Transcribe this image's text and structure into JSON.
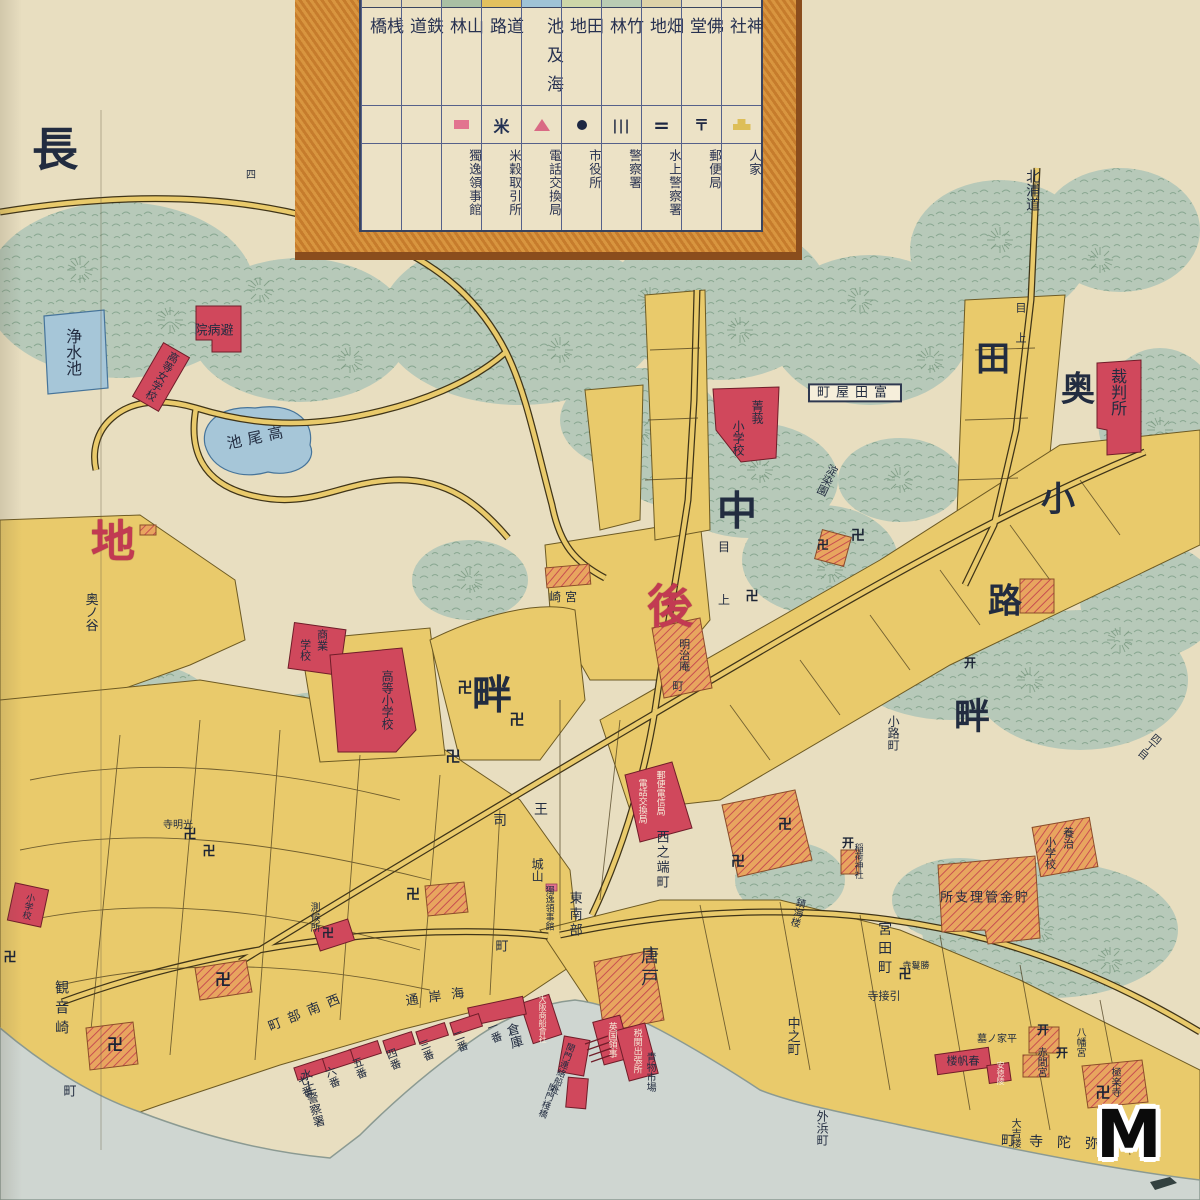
{
  "colors": {
    "paper": "#e8dec0",
    "sea": "#cfd6d1",
    "vegetation": "#b7c9b9",
    "block_yellow": "#e9ca6b",
    "building_red": "#d0485c",
    "temple_hatch": "#e8a55f",
    "pond_blue": "#a6c6d8",
    "legend_border_orange": "#d8953f",
    "ink_navy": "#273150",
    "accent_red_text": "#c23a52"
  },
  "watermark": {
    "text": "M"
  },
  "legend": {
    "columns": [
      {
        "terrain": "桟橋",
        "symbol": "none",
        "facility": "",
        "swatch": "#e4d9b8"
      },
      {
        "terrain": "鉄道",
        "symbol": "none",
        "facility": "",
        "swatch": "#e4d9b8"
      },
      {
        "terrain": "山林",
        "symbol": "pink-rect",
        "facility": "獨逸領事館",
        "swatch": "#a9bfa4"
      },
      {
        "terrain": "道路",
        "symbol": "rice-mark",
        "facility": "米穀取引所",
        "swatch": "#e2c05e"
      },
      {
        "terrain": "池及海",
        "symbol": "pink-triangle",
        "facility": "電話交換局",
        "swatch": "#9fc3d6"
      },
      {
        "terrain": "田地",
        "symbol": "black-circle",
        "facility": "市役所",
        "swatch": "#cdd6a8"
      },
      {
        "terrain": "竹林",
        "symbol": "triple-bar",
        "facility": "警察署",
        "swatch": "#b9ccb4"
      },
      {
        "terrain": "畑地",
        "symbol": "double-bar",
        "facility": "水上警察署",
        "swatch": "#ded2a8"
      },
      {
        "terrain": "佛堂",
        "symbol": "postal-mark",
        "facility": "郵便局",
        "swatch": "#e8dfc4"
      },
      {
        "terrain": "神社",
        "symbol": "house-shape",
        "facility": "人家",
        "swatch": "#e8dfc4"
      }
    ]
  },
  "map": {
    "labels": [
      {
        "t": "長",
        "x": 55,
        "y": 150,
        "o": "h",
        "s": 46,
        "c": "big"
      },
      {
        "t": "地",
        "x": 113,
        "y": 543,
        "o": "h",
        "s": 44,
        "c": "red big"
      },
      {
        "t": "後",
        "x": 670,
        "y": 607,
        "o": "h",
        "s": 46,
        "c": "red big"
      },
      {
        "t": "中",
        "x": 737,
        "y": 512,
        "o": "h",
        "s": 40,
        "c": "big"
      },
      {
        "t": "畔",
        "x": 492,
        "y": 696,
        "o": "h",
        "s": 40,
        "c": "big"
      },
      {
        "t": "畔",
        "x": 972,
        "y": 717,
        "o": "h",
        "s": 36,
        "c": "big"
      },
      {
        "t": "田",
        "x": 993,
        "y": 360,
        "o": "h",
        "s": 34,
        "c": "big"
      },
      {
        "t": "奥",
        "x": 1078,
        "y": 390,
        "o": "h",
        "s": 34,
        "c": "big"
      },
      {
        "t": "小",
        "x": 1058,
        "y": 500,
        "o": "h",
        "s": 34,
        "c": "big"
      },
      {
        "t": "路",
        "x": 1005,
        "y": 602,
        "o": "h",
        "s": 34,
        "c": "big"
      },
      {
        "t": "北浦道",
        "x": 1032,
        "y": 190,
        "o": "v",
        "s": 14
      },
      {
        "t": "浄水池",
        "x": 72,
        "y": 352,
        "o": "v",
        "s": 16
      },
      {
        "t": "池尾高",
        "x": 258,
        "y": 438,
        "o": "h",
        "s": 15,
        "r": -12,
        "ls": 6
      },
      {
        "t": "院病避",
        "x": 214,
        "y": 331,
        "o": "h",
        "s": 13
      },
      {
        "t": "高等女学校",
        "x": 162,
        "y": 376,
        "o": "v",
        "s": 11,
        "r": 30
      },
      {
        "t": "菁莪",
        "x": 757,
        "y": 412,
        "o": "v",
        "s": 12
      },
      {
        "t": "小学校",
        "x": 738,
        "y": 438,
        "o": "v",
        "s": 12
      },
      {
        "t": "町屋田富",
        "x": 855,
        "y": 393,
        "o": "h",
        "s": 13,
        "bg": "box",
        "ls": 6
      },
      {
        "t": "裁判所",
        "x": 1117,
        "y": 392,
        "o": "v",
        "s": 16
      },
      {
        "t": "淀染園",
        "x": 827,
        "y": 480,
        "o": "v",
        "s": 11,
        "r": 25
      },
      {
        "t": "崎宮",
        "x": 565,
        "y": 597,
        "o": "h",
        "s": 12,
        "ls": 4
      },
      {
        "t": "目",
        "x": 724,
        "y": 547,
        "o": "h",
        "s": 12
      },
      {
        "t": "上",
        "x": 724,
        "y": 600,
        "o": "h",
        "s": 12
      },
      {
        "t": "明治庵",
        "x": 684,
        "y": 655,
        "o": "v",
        "s": 11
      },
      {
        "t": "町",
        "x": 678,
        "y": 686,
        "o": "h",
        "s": 11
      },
      {
        "t": "奥ノ谷",
        "x": 90,
        "y": 612,
        "o": "v",
        "s": 13
      },
      {
        "t": "商業",
        "x": 322,
        "y": 640,
        "o": "v",
        "s": 11
      },
      {
        "t": "学校",
        "x": 305,
        "y": 650,
        "o": "v",
        "s": 11
      },
      {
        "t": "高等小学校",
        "x": 387,
        "y": 700,
        "o": "v",
        "s": 12
      },
      {
        "t": "王",
        "x": 541,
        "y": 810,
        "o": "h",
        "s": 14
      },
      {
        "t": "司",
        "x": 500,
        "y": 821,
        "o": "h",
        "s": 14
      },
      {
        "t": "電話交換局",
        "x": 641,
        "y": 801,
        "o": "v",
        "s": 9,
        "c": "white"
      },
      {
        "t": "郵便電信局",
        "x": 659,
        "y": 793,
        "o": "v",
        "s": 9,
        "c": "white"
      },
      {
        "t": "西之端町",
        "x": 661,
        "y": 860,
        "o": "v",
        "s": 13,
        "ls": 2
      },
      {
        "t": "城山",
        "x": 537,
        "y": 870,
        "o": "v",
        "s": 12
      },
      {
        "t": "獨逸領事館",
        "x": 548,
        "y": 908,
        "o": "v",
        "s": 9
      },
      {
        "t": "東南部",
        "x": 574,
        "y": 915,
        "o": "v",
        "s": 13,
        "ls": 3
      },
      {
        "t": "町",
        "x": 502,
        "y": 947,
        "o": "h",
        "s": 13
      },
      {
        "t": "通岸海",
        "x": 440,
        "y": 997,
        "o": "h",
        "s": 13,
        "r": -8,
        "ls": 10
      },
      {
        "t": "町部南西",
        "x": 308,
        "y": 1012,
        "o": "h",
        "s": 13,
        "r": -22,
        "ls": 8
      },
      {
        "t": "観音崎",
        "x": 61,
        "y": 1010,
        "o": "v",
        "s": 14,
        "ls": 6
      },
      {
        "t": "町",
        "x": 70,
        "y": 1092,
        "o": "h",
        "s": 13
      },
      {
        "t": "寺明光",
        "x": 178,
        "y": 826,
        "o": "h",
        "s": 10
      },
      {
        "t": "測候所",
        "x": 313,
        "y": 917,
        "o": "v",
        "s": 10
      },
      {
        "t": "小学校",
        "x": 27,
        "y": 906,
        "o": "v",
        "s": 9,
        "r": 12
      },
      {
        "t": "一番",
        "x": 494,
        "y": 1032,
        "o": "v",
        "s": 11,
        "r": -20
      },
      {
        "t": "二番",
        "x": 460,
        "y": 1041,
        "o": "v",
        "s": 11,
        "r": -20
      },
      {
        "t": "三番",
        "x": 426,
        "y": 1050,
        "o": "v",
        "s": 11,
        "r": -20
      },
      {
        "t": "四番",
        "x": 393,
        "y": 1059,
        "o": "v",
        "s": 11,
        "r": -20
      },
      {
        "t": "五番",
        "x": 359,
        "y": 1068,
        "o": "v",
        "s": 11,
        "r": -20
      },
      {
        "t": "六番",
        "x": 332,
        "y": 1077,
        "o": "v",
        "s": 11,
        "r": -20
      },
      {
        "t": "七番",
        "x": 305,
        "y": 1086,
        "o": "v",
        "s": 11,
        "r": -20
      },
      {
        "t": "水上警察署",
        "x": 312,
        "y": 1098,
        "o": "v",
        "s": 12,
        "r": -15
      },
      {
        "t": "倉庫",
        "x": 513,
        "y": 1036,
        "o": "v",
        "s": 13,
        "r": -15
      },
      {
        "t": "大阪商船會社",
        "x": 542,
        "y": 1019,
        "o": "v",
        "s": 8,
        "c": "white"
      },
      {
        "t": "関門連絡船社",
        "x": 561,
        "y": 1068,
        "o": "v",
        "s": 9,
        "r": 20
      },
      {
        "t": "関門棧橋",
        "x": 546,
        "y": 1100,
        "o": "v",
        "s": 9,
        "r": 20
      },
      {
        "t": "英国領事",
        "x": 611,
        "y": 1040,
        "o": "v",
        "s": 9,
        "c": "white"
      },
      {
        "t": "税関出張所",
        "x": 636,
        "y": 1051,
        "o": "v",
        "s": 9,
        "c": "white"
      },
      {
        "t": "唐戸",
        "x": 648,
        "y": 968,
        "o": "v",
        "s": 18,
        "ls": 4
      },
      {
        "t": "青物市場",
        "x": 649,
        "y": 1072,
        "o": "v",
        "s": 10
      },
      {
        "t": "中之町",
        "x": 792,
        "y": 1036,
        "o": "v",
        "s": 13
      },
      {
        "t": "宮田町",
        "x": 884,
        "y": 950,
        "o": "v",
        "s": 14,
        "ls": 5
      },
      {
        "t": "寺接引",
        "x": 884,
        "y": 996,
        "o": "h",
        "s": 11
      },
      {
        "t": "稲荷神社",
        "x": 857,
        "y": 861,
        "o": "v",
        "s": 9
      },
      {
        "t": "鎮海楼",
        "x": 796,
        "y": 912,
        "o": "v",
        "s": 10,
        "r": 15
      },
      {
        "t": "所支理管金貯",
        "x": 985,
        "y": 898,
        "o": "h",
        "s": 13,
        "ls": 2
      },
      {
        "t": "養治",
        "x": 1068,
        "y": 838,
        "o": "v",
        "s": 11
      },
      {
        "t": "小学校",
        "x": 1050,
        "y": 853,
        "o": "v",
        "s": 11
      },
      {
        "t": "寺鬘勝",
        "x": 916,
        "y": 967,
        "o": "h",
        "s": 9
      },
      {
        "t": "楼帆春",
        "x": 963,
        "y": 1061,
        "o": "h",
        "s": 11
      },
      {
        "t": "墓ノ家平",
        "x": 997,
        "y": 1040,
        "o": "h",
        "s": 10
      },
      {
        "t": "赤間宮",
        "x": 1040,
        "y": 1062,
        "o": "v",
        "s": 10
      },
      {
        "t": "八幡宮",
        "x": 1079,
        "y": 1042,
        "o": "v",
        "s": 10
      },
      {
        "t": "極楽寺",
        "x": 1114,
        "y": 1082,
        "o": "v",
        "s": 10
      },
      {
        "t": "安徳陵",
        "x": 1000,
        "y": 1073,
        "o": "v",
        "s": 8,
        "c": "white"
      },
      {
        "t": "大吉楼",
        "x": 1014,
        "y": 1133,
        "o": "v",
        "s": 10
      },
      {
        "t": "町寺陀弥",
        "x": 1057,
        "y": 1143,
        "o": "h",
        "s": 14,
        "ls": 14,
        "r": 2
      },
      {
        "t": "外浜町",
        "x": 822,
        "y": 1128,
        "o": "v",
        "s": 12
      },
      {
        "t": "小路町",
        "x": 893,
        "y": 733,
        "o": "v",
        "s": 12
      },
      {
        "t": "四",
        "x": 251,
        "y": 176,
        "o": "h",
        "s": 10
      },
      {
        "t": "丁",
        "x": 318,
        "y": 206,
        "o": "h",
        "s": 10
      },
      {
        "t": "十",
        "x": 422,
        "y": 250,
        "o": "h",
        "s": 10
      },
      {
        "t": "目",
        "x": 1021,
        "y": 308,
        "o": "h",
        "s": 11
      },
      {
        "t": "上",
        "x": 1021,
        "y": 338,
        "o": "h",
        "s": 11
      },
      {
        "t": "四丁目",
        "x": 1148,
        "y": 745,
        "o": "v",
        "s": 10,
        "r": 40
      }
    ],
    "marks": [
      {
        "g": "卍",
        "x": 465,
        "y": 688,
        "s": 15
      },
      {
        "g": "卍",
        "x": 517,
        "y": 720,
        "s": 15
      },
      {
        "g": "卍",
        "x": 453,
        "y": 757,
        "s": 15
      },
      {
        "g": "卍",
        "x": 413,
        "y": 895,
        "s": 14
      },
      {
        "g": "卍",
        "x": 190,
        "y": 835,
        "s": 13
      },
      {
        "g": "卍",
        "x": 209,
        "y": 852,
        "s": 13
      },
      {
        "g": "卍",
        "x": 115,
        "y": 1045,
        "s": 16
      },
      {
        "g": "卍",
        "x": 223,
        "y": 980,
        "s": 16
      },
      {
        "g": "卍",
        "x": 10,
        "y": 958,
        "s": 13
      },
      {
        "g": "卍",
        "x": 858,
        "y": 536,
        "s": 14
      },
      {
        "g": "卍",
        "x": 752,
        "y": 597,
        "s": 13
      },
      {
        "g": "卍",
        "x": 328,
        "y": 933,
        "s": 12
      },
      {
        "g": "卍",
        "x": 738,
        "y": 862,
        "s": 14
      },
      {
        "g": "卍",
        "x": 785,
        "y": 825,
        "s": 14
      },
      {
        "g": "卍",
        "x": 905,
        "y": 975,
        "s": 13
      },
      {
        "g": "卍",
        "x": 1103,
        "y": 1093,
        "s": 15
      },
      {
        "g": "卍",
        "x": 823,
        "y": 545,
        "s": 12
      },
      {
        "g": "开",
        "x": 848,
        "y": 843,
        "s": 12
      },
      {
        "g": "开",
        "x": 1043,
        "y": 1030,
        "s": 12
      },
      {
        "g": "开",
        "x": 1062,
        "y": 1053,
        "s": 12
      },
      {
        "g": "开",
        "x": 970,
        "y": 663,
        "s": 12
      }
    ]
  }
}
